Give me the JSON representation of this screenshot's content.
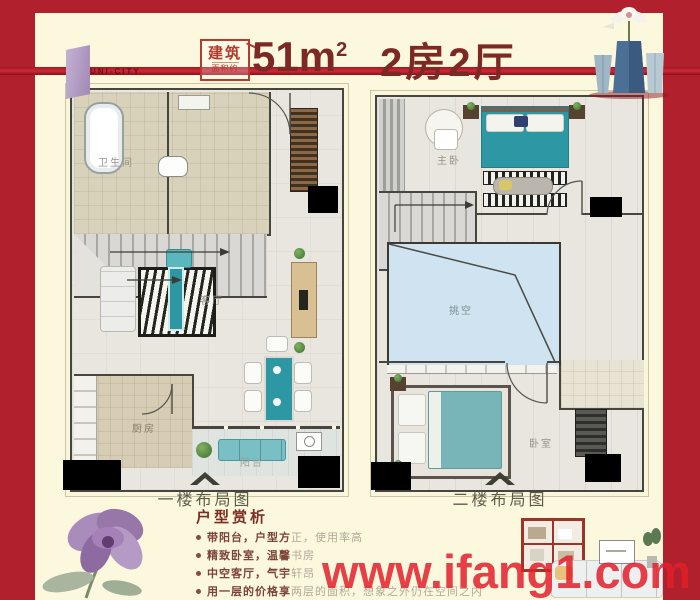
{
  "poster": {
    "brand": "UNI-CITY",
    "badge": {
      "line1": "建筑",
      "line2": "面积约"
    },
    "area": {
      "value": "51m",
      "sup": "2"
    },
    "title": "2房2厅",
    "watermark": "www.ifang1.com"
  },
  "plans": {
    "first": {
      "caption": "一楼布局图",
      "rooms": {
        "bathroom": "卫生间",
        "living": "客厅",
        "kitchen": "厨房",
        "balcony": "阳台"
      }
    },
    "second": {
      "caption": "二楼布局图",
      "rooms": {
        "master": "主卧",
        "void": "挑空",
        "bedroom": "卧室"
      }
    }
  },
  "analysis": {
    "heading": "户型赏析",
    "bullets": [
      {
        "strong": "带阳台，户型方",
        "rest": "正，使用率高"
      },
      {
        "strong": "精致卧室，温馨",
        "rest": "书房"
      },
      {
        "strong": "中空客厅，气宇",
        "rest": "轩昂"
      },
      {
        "strong": "用一层的价格享",
        "rest": "两层的面积，想象之外仍在空间之内"
      }
    ]
  },
  "colors": {
    "border_red": "#b1212d",
    "cream": "#fbf8dd",
    "title_red": "#7c2824",
    "accent_teal": "#2d98a4",
    "void_blue": "#cfe4f0",
    "watermark_red": "#e21e2a"
  }
}
